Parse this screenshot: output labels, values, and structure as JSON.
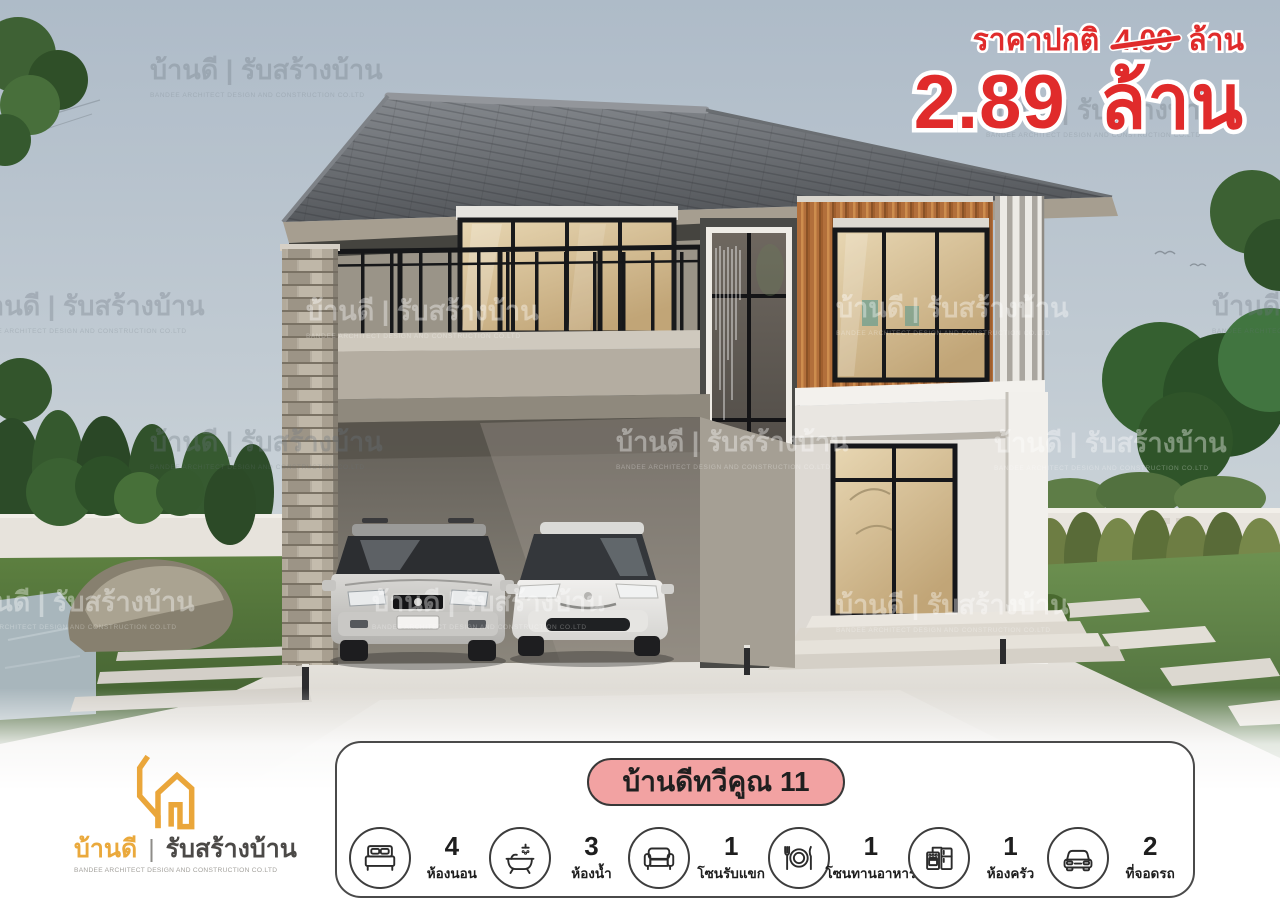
{
  "ad": {
    "regular_price_label": "ราคาปกติ",
    "regular_price_value": "4.09",
    "regular_price_unit": "ล้าน",
    "sale_price_value": "2.89",
    "sale_price_unit": "ล้าน"
  },
  "model_badge": {
    "name": "บ้านดีทวีคูณ 11"
  },
  "features": [
    {
      "icon": "bed-icon",
      "count": "4",
      "label": "ห้องนอน"
    },
    {
      "icon": "bathtub-icon",
      "count": "3",
      "label": "ห้องน้ำ"
    },
    {
      "icon": "sofa-icon",
      "count": "1",
      "label": "โซนรับแขก"
    },
    {
      "icon": "dining-icon",
      "count": "1",
      "label": "โซนทานอาหาร"
    },
    {
      "icon": "kitchen-icon",
      "count": "1",
      "label": "ห้องครัว"
    },
    {
      "icon": "car-icon",
      "count": "2",
      "label": "ที่จอดรถ"
    }
  ],
  "logo": {
    "brand": "บ้านดี",
    "divider": "|",
    "tagline": "รับสร้างบ้าน",
    "subtitle": "BANDEE ARCHITECT DESIGN AND CONSTRUCTION CO.LTD"
  },
  "watermark": {
    "text": "บ้านดี | รับสร้างบ้าน",
    "subtext": "BANDEE ARCHITECT DESIGN AND CONSTRUCTION CO.LTD"
  },
  "colors": {
    "price_red": "#e02b2b",
    "badge_pink": "#f2a2a2",
    "brand_gold": "#eaa63a",
    "sky": "#b7c3ce",
    "wood_accent": "#b06e3a"
  }
}
